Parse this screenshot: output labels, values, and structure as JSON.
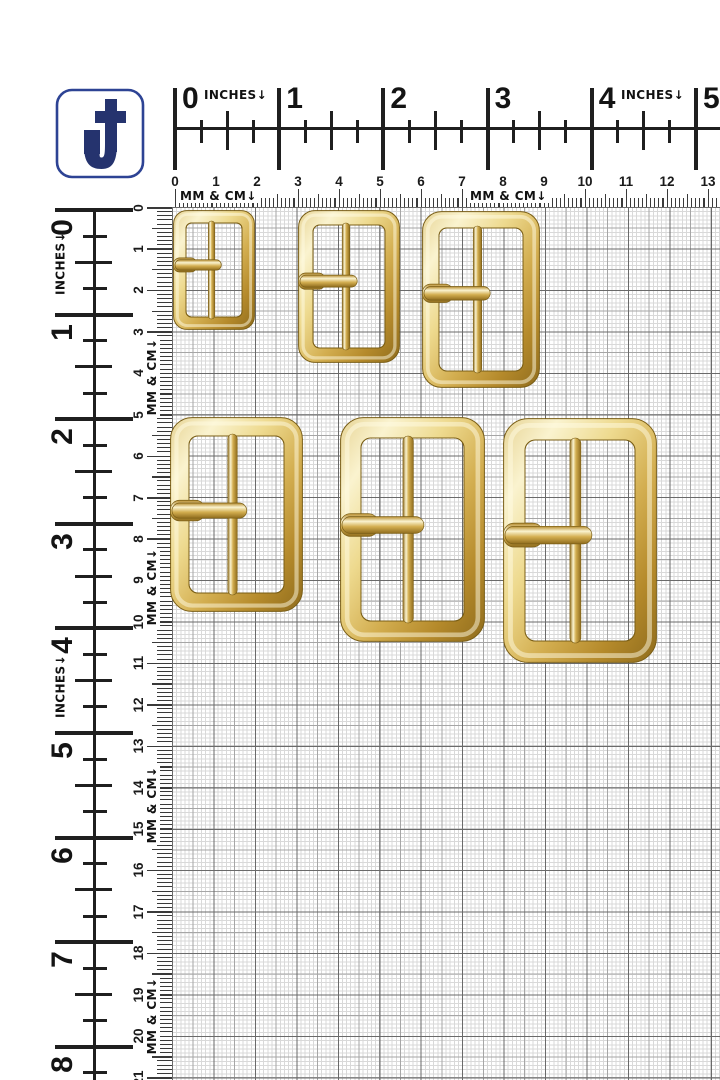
{
  "logo": {
    "letter": "J",
    "border_color": "#2d4394",
    "glyph_color": "#25336e",
    "background": "#ffffff"
  },
  "rulers": {
    "top": {
      "inches": {
        "unit_label": "INCHES↓",
        "numbers": [
          "0",
          "1",
          "2",
          "3",
          "4",
          "5"
        ]
      },
      "cm": {
        "unit_label": "MM & CM↓",
        "numbers": [
          "0",
          "1",
          "2",
          "3",
          "4",
          "5",
          "6",
          "7",
          "8",
          "9",
          "10",
          "11",
          "12",
          "13"
        ]
      }
    },
    "left": {
      "inches": {
        "unit_label": "INCHES↓",
        "numbers": [
          "0",
          "1",
          "2",
          "3",
          "4",
          "5",
          "6",
          "7",
          "8"
        ]
      },
      "cm": {
        "unit_label": "MM & CM↓",
        "numbers": [
          "0",
          "1",
          "2",
          "3",
          "4",
          "5",
          "6",
          "7",
          "8",
          "9",
          "10",
          "11",
          "12",
          "13",
          "14",
          "15",
          "16",
          "17",
          "18",
          "19",
          "20",
          "21"
        ]
      }
    }
  },
  "grid": {
    "background": "#ffffff",
    "line_colors": {
      "mm": "#d9d9d9",
      "half_cm": "#a6a6a6",
      "cm": "#6a6a6a"
    }
  },
  "buckles": [
    {
      "name": "buckle-1-small",
      "x": 173,
      "y": 210,
      "w": 82,
      "h": 120,
      "frame": 13,
      "prong_frac": 0.458
    },
    {
      "name": "buckle-2-medium",
      "x": 298,
      "y": 210,
      "w": 102,
      "h": 153,
      "frame": 15,
      "prong_frac": 0.465
    },
    {
      "name": "buckle-3-large",
      "x": 422,
      "y": 211,
      "w": 118,
      "h": 177,
      "frame": 17,
      "prong_frac": 0.465
    },
    {
      "name": "buckle-4-xl",
      "x": 170,
      "y": 417,
      "w": 133,
      "h": 195,
      "frame": 19,
      "prong_frac": 0.48
    },
    {
      "name": "buckle-5-xxl",
      "x": 340,
      "y": 417,
      "w": 145,
      "h": 225,
      "frame": 21,
      "prong_frac": 0.48
    },
    {
      "name": "buckle-6-xxxl",
      "x": 503,
      "y": 418,
      "w": 154,
      "h": 245,
      "frame": 22,
      "prong_frac": 0.478
    }
  ],
  "gold_palette": {
    "edge1": "#e7d495",
    "hi": "#faf3cf",
    "light": "#eeda8f",
    "mid": "#d3ae50",
    "dark": "#b58a2b",
    "deep": "#8f6c1d",
    "outline": "#7a5e16"
  }
}
